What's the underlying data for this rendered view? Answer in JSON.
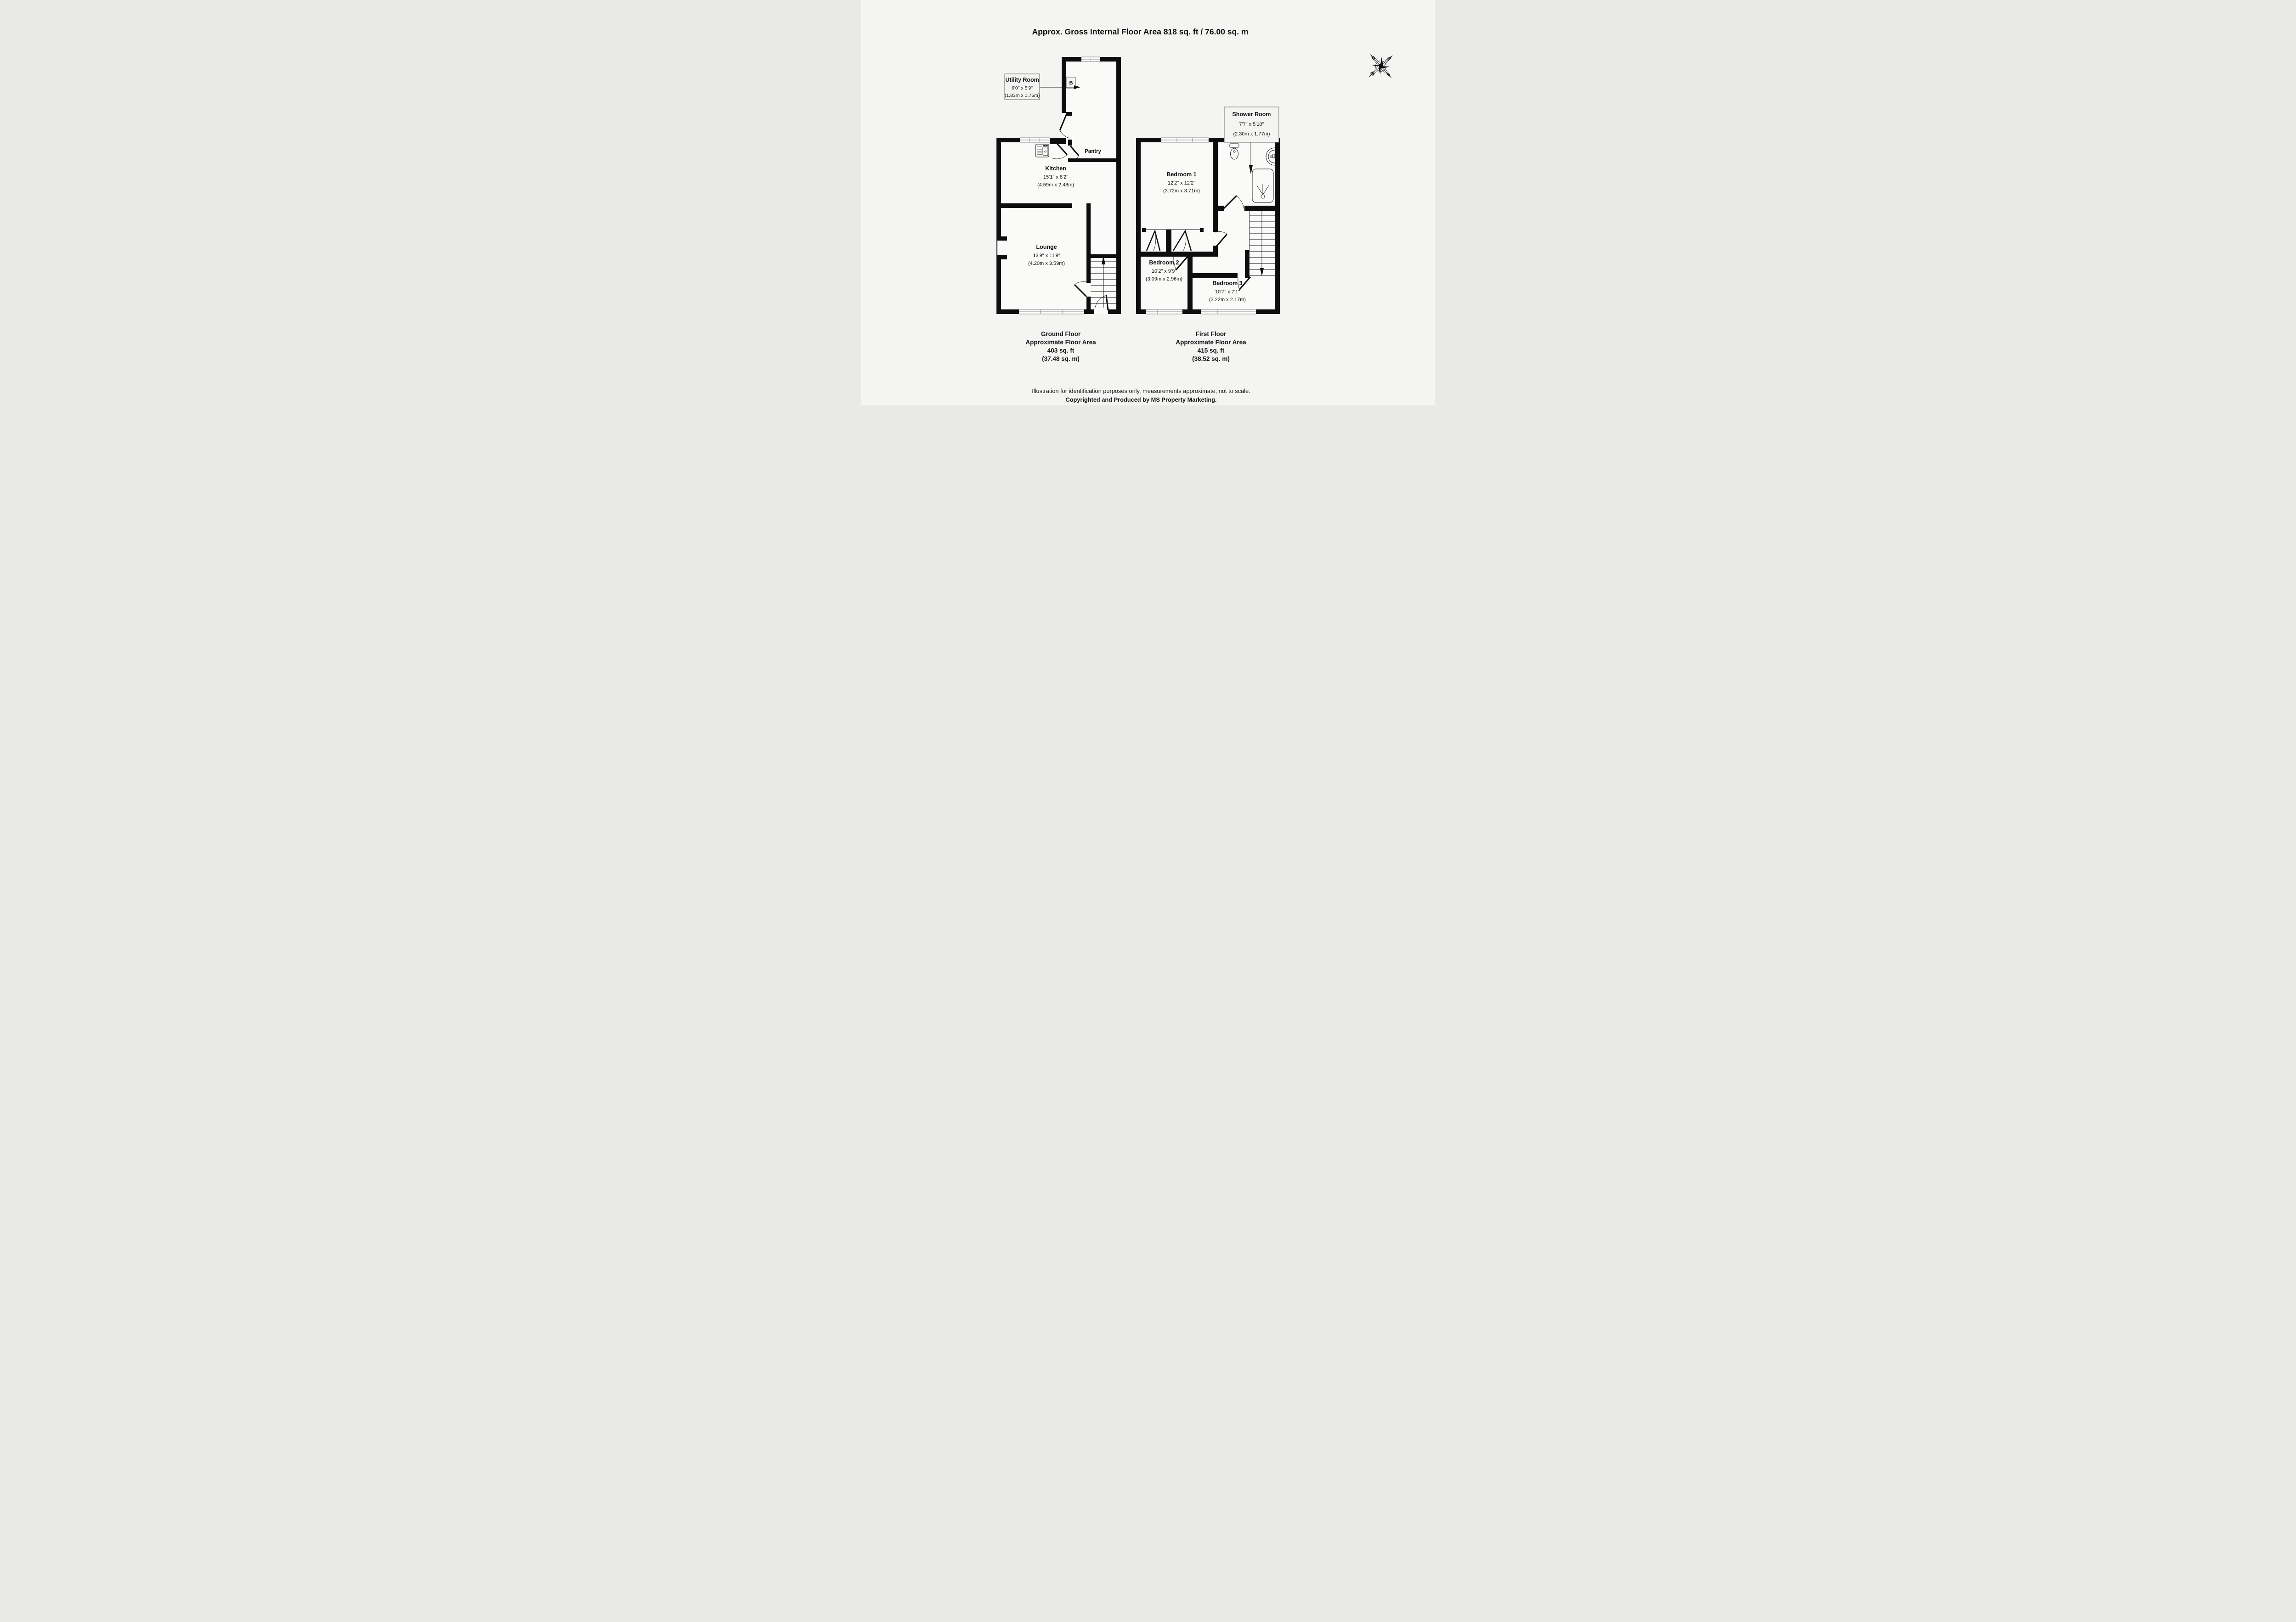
{
  "title": "Approx. Gross Internal Floor Area 818 sq. ft / 76.00 sq. m",
  "compass": {
    "n": "N",
    "e": "E",
    "s": "S",
    "w": "W"
  },
  "ground_floor": {
    "caption_line1": "Ground Floor",
    "caption_line2": "Approximate Floor Area",
    "caption_line3": "403 sq. ft",
    "caption_line4": "(37.48 sq. m)",
    "rooms": {
      "utility": {
        "name": "Utility Room",
        "imperial": "6'0\" x 5'9\"",
        "metric": "(1.83m x 1.75m)"
      },
      "kitchen": {
        "name": "Kitchen",
        "imperial": "15'1\" x 8'2\"",
        "metric": "(4.59m x 2.48m)"
      },
      "pantry": {
        "name": "Pantry"
      },
      "lounge": {
        "name": "Lounge",
        "imperial": "13'9\" x 11'9\"",
        "metric": "(4.20m x 3.59m)"
      },
      "boiler": "B"
    }
  },
  "first_floor": {
    "caption_line1": "First Floor",
    "caption_line2": "Approximate Floor Area",
    "caption_line3": "415 sq. ft",
    "caption_line4": "(38.52 sq. m)",
    "rooms": {
      "shower": {
        "name": "Shower Room",
        "imperial": "7'7\" x 5'10\"",
        "metric": "(2.30m x 1.77m)"
      },
      "bedroom1": {
        "name": "Bedroom 1",
        "imperial": "12'2\" x 12'2\"",
        "metric": "(3.72m x 3.71m)"
      },
      "bedroom2": {
        "name": "Bedroom 2",
        "imperial": "10'2\" x 9'9\"",
        "metric": "(3.09m x 2.96m)"
      },
      "bedroom3": {
        "name": "Bedroom 3",
        "imperial": "10'7\" x 7'1\"",
        "metric": "(3.22m x 2.17m)"
      }
    }
  },
  "footer": {
    "line1": "Illustration for identification purposes only, measurements approximate, not to scale.",
    "line2": "Copyrighted  and Produced by MS Property Marketing."
  },
  "colors": {
    "wall": "#0d0d0d",
    "background": "#f4f4f3",
    "window_line": "#8a8a8a"
  }
}
